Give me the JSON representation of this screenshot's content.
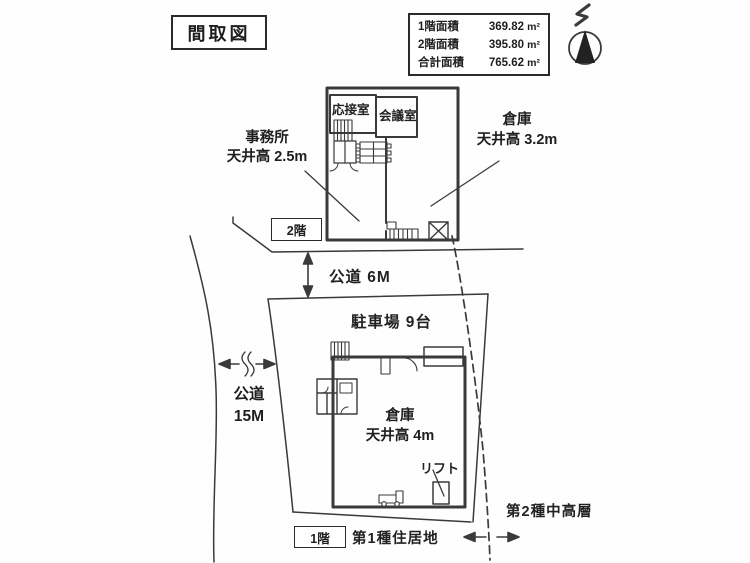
{
  "title": "間取図",
  "area_table": {
    "rows": [
      {
        "label": "1階面積",
        "value": "369.82",
        "unit": "m²"
      },
      {
        "label": "2階面積",
        "value": "395.80",
        "unit": "m²"
      },
      {
        "label": "合計面積",
        "value": "765.62",
        "unit": "m²"
      }
    ]
  },
  "second_floor": {
    "floor_tag": "2階",
    "reception_room": "応接室",
    "meeting_room": "会議室",
    "office_line1": "事務所",
    "office_line2": "天井高 2.5m",
    "warehouse_line1": "倉庫",
    "warehouse_line2": "天井高 3.2m"
  },
  "first_floor": {
    "floor_tag": "1階",
    "parking": "駐車場 9台",
    "warehouse_line1": "倉庫",
    "warehouse_line2": "天井高 4m",
    "lift": "リフト"
  },
  "roads": {
    "front_road": "公道 6M",
    "side_road_line1": "公道",
    "side_road_line2": "15M"
  },
  "zoning": {
    "left_zone": "第1種住居地",
    "right_zone": "第2種中高層"
  },
  "colors": {
    "line": "#3a3a3a",
    "ink": "#1e1e1e"
  }
}
